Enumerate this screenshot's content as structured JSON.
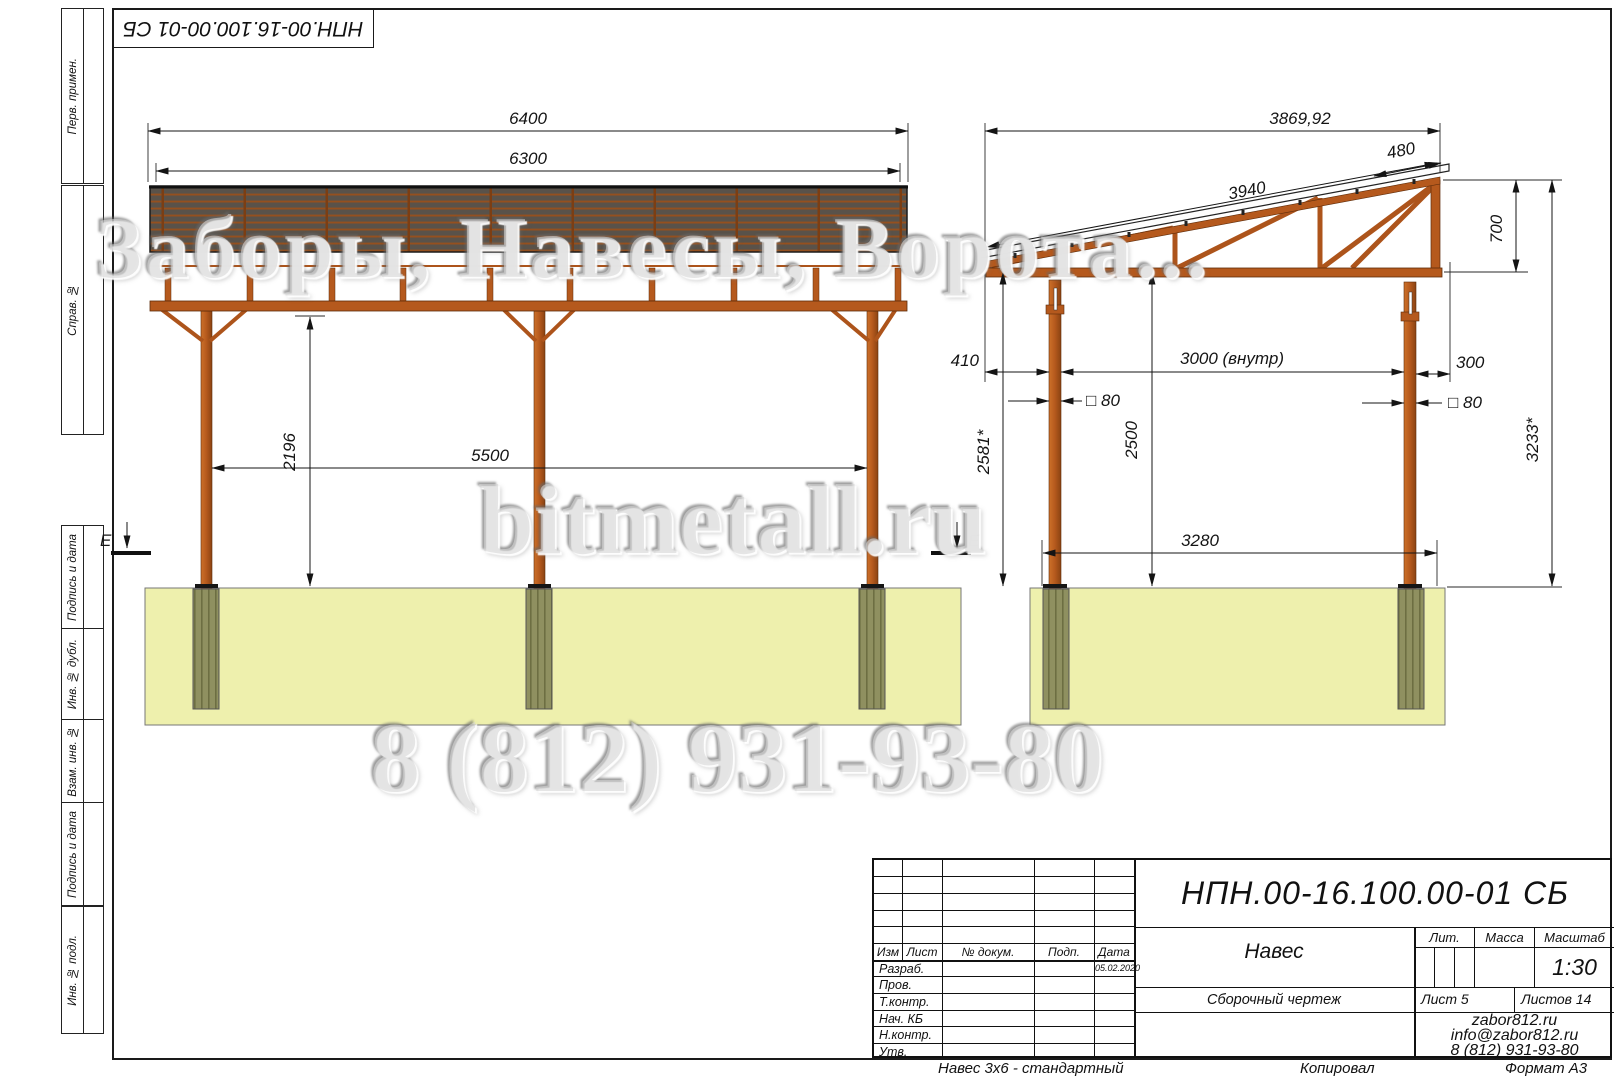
{
  "stamp": {
    "code": "НПН.00-16.100.00-01 СБ"
  },
  "left_strip": {
    "labels": [
      "Перв. примен.",
      "Справ. №",
      "Подпись и дата",
      "Инв. № дубл.",
      "Взам. инв. №",
      "Подпись и дата",
      "Инв. № подл."
    ]
  },
  "watermarks": {
    "line1": "Заборы, Навесы, Ворота...",
    "line2": "bitmetall.ru",
    "line3": "8 (812) 931-93-80"
  },
  "front_view": {
    "section_mark": "E",
    "dims": {
      "overall_width": "6400",
      "roof_width": "6300",
      "clear_height": "2196",
      "post_spacing": "5500"
    }
  },
  "side_view": {
    "dims": {
      "overall_slope": "3869,92",
      "overhang": "480",
      "roof_slope": "3940",
      "truss_height": "700",
      "left_offset": "410",
      "inner_width": "3000 (внутр)",
      "right_offset": "300",
      "post_section_left": "□ 80",
      "post_section_right": "□ 80",
      "height_left": "2581*",
      "clear_height": "2500",
      "footing_spacing": "3280",
      "total_height": "3233*"
    }
  },
  "title_block": {
    "designation": "НПН.00-16.100.00-01 СБ",
    "rev_headers": {
      "izm": "Изм",
      "list": "Лист",
      "doc": "№ докум.",
      "sign": "Подп.",
      "date": "Дата"
    },
    "roles": [
      "Разраб.",
      "Пров.",
      "Т.контр.",
      "Нач. КБ",
      "Н.контр.",
      "Утв."
    ],
    "date": "05.02.2020",
    "name": "Навес",
    "doc_type": "Сборочный чертеж",
    "lit_label": "Лит.",
    "mass_label": "Масса",
    "scale_label": "Масштаб",
    "scale": "1:30",
    "sheet": "Лист 5",
    "sheets": "Листов 14",
    "site": "zabor812.ru",
    "email": "info@zabor812.ru",
    "phone": "8 (812) 931-93-80"
  },
  "footer": {
    "product": "Навес 3х6 - стандартный",
    "copied": "Копировал",
    "format": "Формат А3"
  },
  "colors": {
    "structure": "#b5591d",
    "roof_dark": "#59524a",
    "slab": "#eef0ad",
    "footing": "#8f9060"
  }
}
